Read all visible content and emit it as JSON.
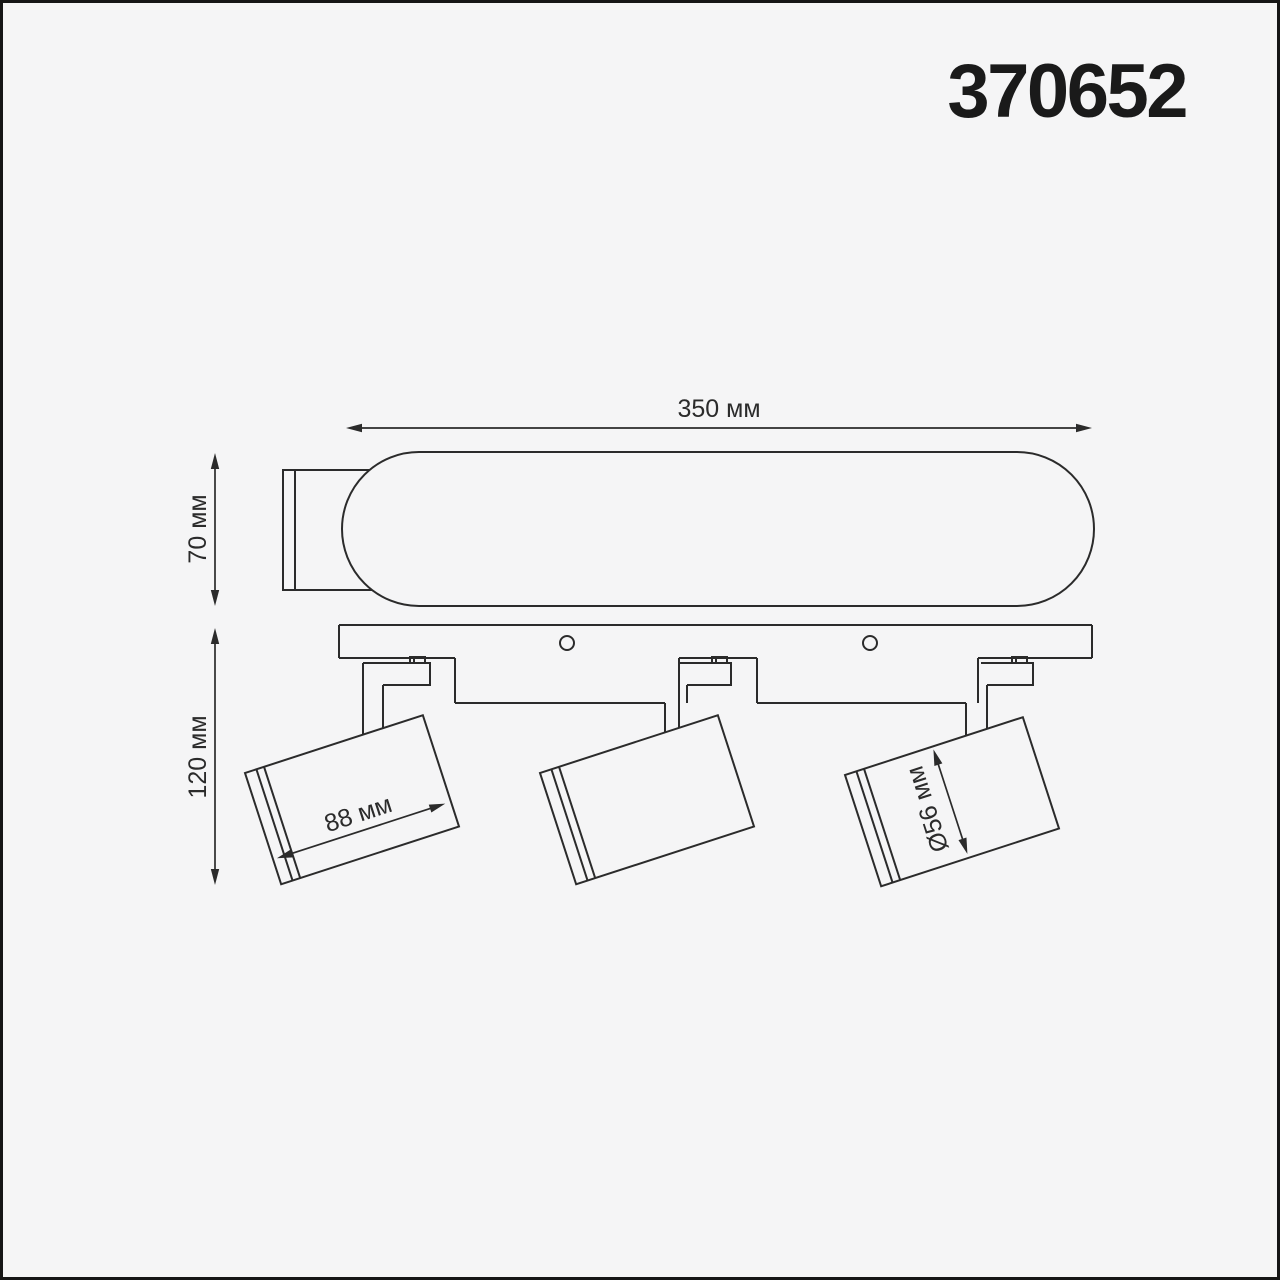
{
  "product_code": "370652",
  "drawing": {
    "type": "technical-dimension-drawing",
    "views": [
      "fixture-body-top-view",
      "fixture-side-view-with-spots"
    ],
    "spot_count": 3
  },
  "dimensions": {
    "bar_length_label": "350 мм",
    "body_height_label": "70 мм",
    "spot_drop_label": "120 мм",
    "spot_length_label": "88 мм",
    "spot_diameter_label": "Ø56 мм"
  },
  "colors": {
    "background": "#f5f5f6",
    "line": "#2b2b2b",
    "text": "#1a1a1a",
    "border": "#161616"
  }
}
